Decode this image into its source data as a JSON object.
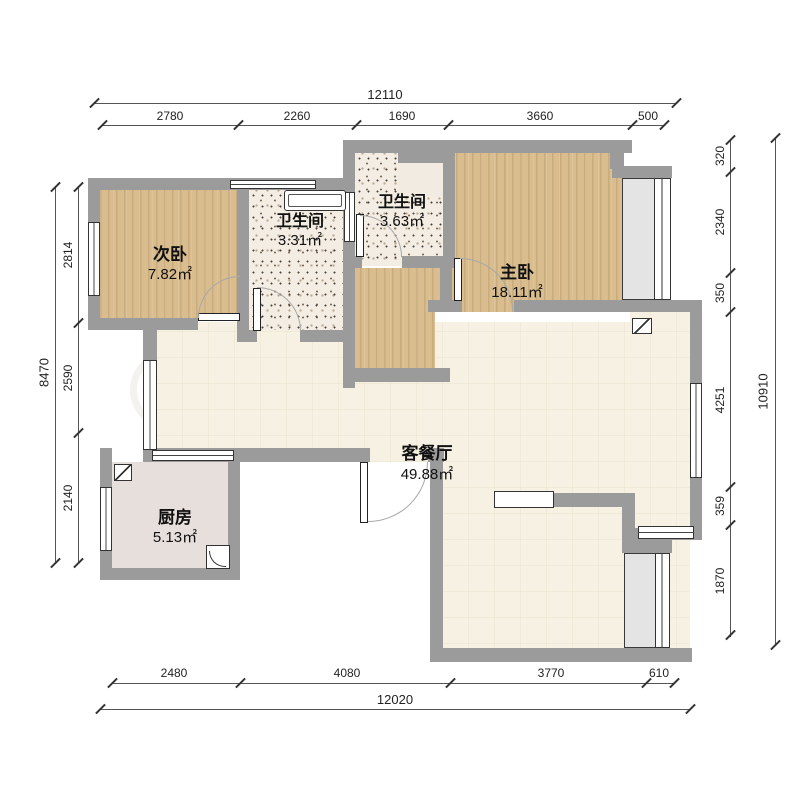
{
  "rooms": [
    {
      "name": "次卧",
      "area": "7.82㎡"
    },
    {
      "name": "卫生间",
      "area": "3.31㎡"
    },
    {
      "name": "卫生间",
      "area": "3.63㎡"
    },
    {
      "name": "主卧",
      "area": "18.11㎡"
    },
    {
      "name": "客餐厅",
      "area": "49.88㎡"
    },
    {
      "name": "厨房",
      "area": "5.13㎡"
    }
  ],
  "dimensions": {
    "top": {
      "total": "12110",
      "segments": [
        "2780",
        "2260",
        "1690",
        "3660",
        "500"
      ]
    },
    "bottom": {
      "total": "12020",
      "segments": [
        "2480",
        "4080",
        "3770",
        "610"
      ]
    },
    "left": {
      "total": "8470",
      "segments": [
        "2814",
        "2590",
        "2140"
      ]
    },
    "right": {
      "total": "10910",
      "segments": [
        "320",
        "2340",
        "350",
        "4251",
        "359",
        "1870"
      ]
    }
  },
  "colors": {
    "wall": "#9b9b9b",
    "wood_floor": "#d9bd8f",
    "bath_floor": "#f4ede3",
    "living_floor": "#f6f1e2",
    "kitchen_floor": "#e7dfdc",
    "window_sill": "#e4e4e4",
    "dimension_text": "#222222"
  }
}
